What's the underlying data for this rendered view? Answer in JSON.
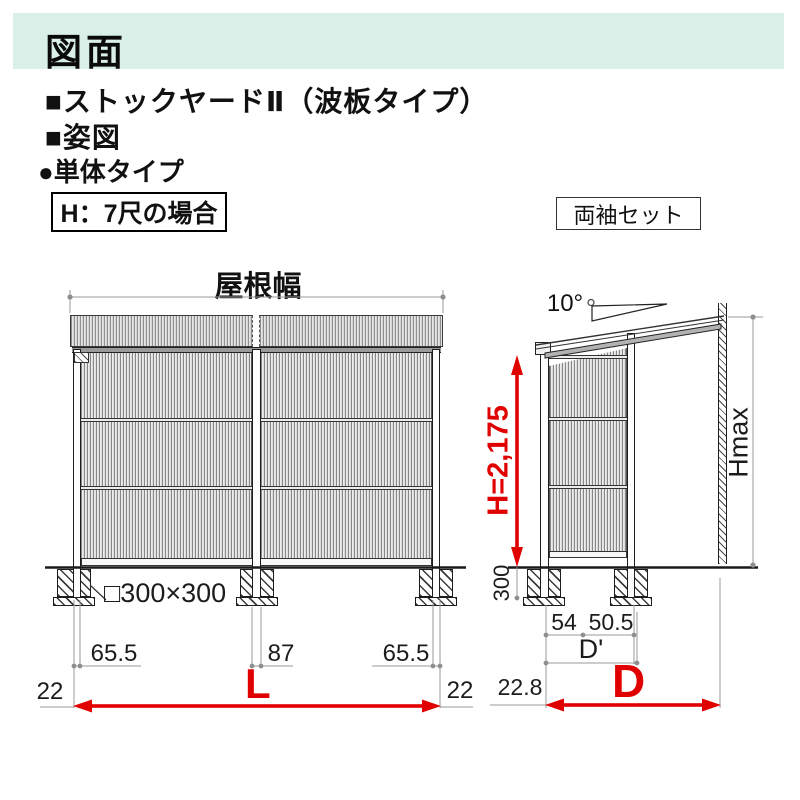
{
  "header": {
    "title": "図面"
  },
  "headings": {
    "product": "■ストックヤードⅡ（波板タイプ）",
    "view": "■姿図",
    "unit_type": "●単体タイプ",
    "height_case": "H：7尺の場合",
    "set_type": "両袖セット"
  },
  "front_view": {
    "roof_width_label": "屋根幅",
    "foundation_size": "□300×300",
    "dim_left": "65.5",
    "dim_center": "87",
    "dim_right": "65.5",
    "offset_left": "22",
    "offset_right": "22",
    "width_symbol": "L"
  },
  "side_view": {
    "roof_angle": "10°",
    "height_dim": "H=2,175",
    "embed_depth": "300",
    "max_height_symbol": "Hmax",
    "dim_post": "54",
    "dim_eave": "50.5",
    "inner_depth_symbol": "D'",
    "offset_front": "22.8",
    "depth_symbol": "D"
  },
  "colors": {
    "header_bar": "#d9efe8",
    "dimension_red": "#e00000",
    "dim_line_gray": "#9a9a9a"
  }
}
